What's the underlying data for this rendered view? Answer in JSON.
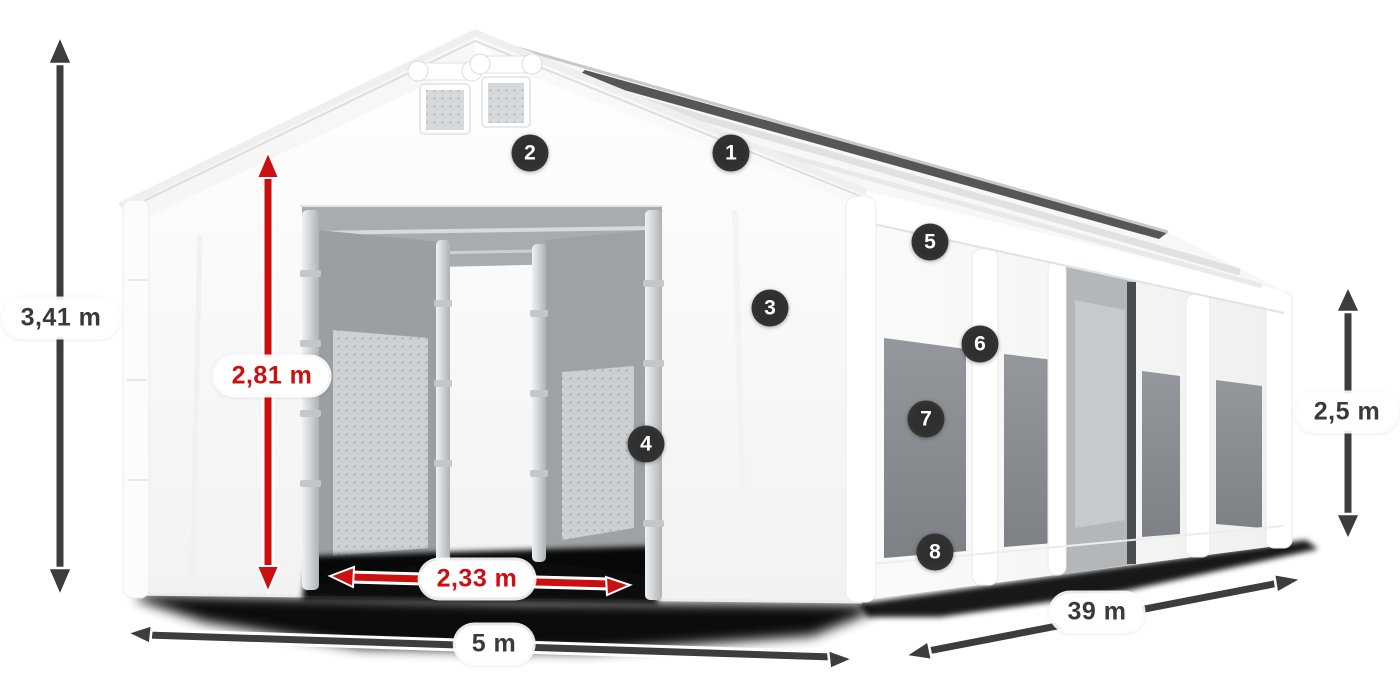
{
  "illustration": {
    "subject": "tent-product-render"
  },
  "dimension_labels": {
    "total_height": {
      "label": "3,41 m",
      "color": "#3a3a3a"
    },
    "entrance_height": {
      "label": "2,81 m",
      "color": "#cc0f0f"
    },
    "entrance_width": {
      "label": "2,33 m",
      "color": "#cc0f0f"
    },
    "tent_width": {
      "label": "5 m",
      "color": "#3a3a3a"
    },
    "tent_length": {
      "label": "39 m",
      "color": "#3a3a3a"
    },
    "side_height": {
      "label": "2,5 m",
      "color": "#3a3a3a"
    }
  },
  "feature_markers": [
    {
      "number": "1"
    },
    {
      "number": "2"
    },
    {
      "number": "3"
    },
    {
      "number": "4"
    },
    {
      "number": "5"
    },
    {
      "number": "6"
    },
    {
      "number": "7"
    },
    {
      "number": "8"
    }
  ],
  "colors": {
    "accent_red": "#cc0f0f",
    "arrow_dark": "#3d3d3d",
    "marker_bg": "#2f2f2f",
    "tent_white": "#fdfdfd",
    "interior_gray": "#9b9fa2",
    "window_gray": "#83878b"
  }
}
